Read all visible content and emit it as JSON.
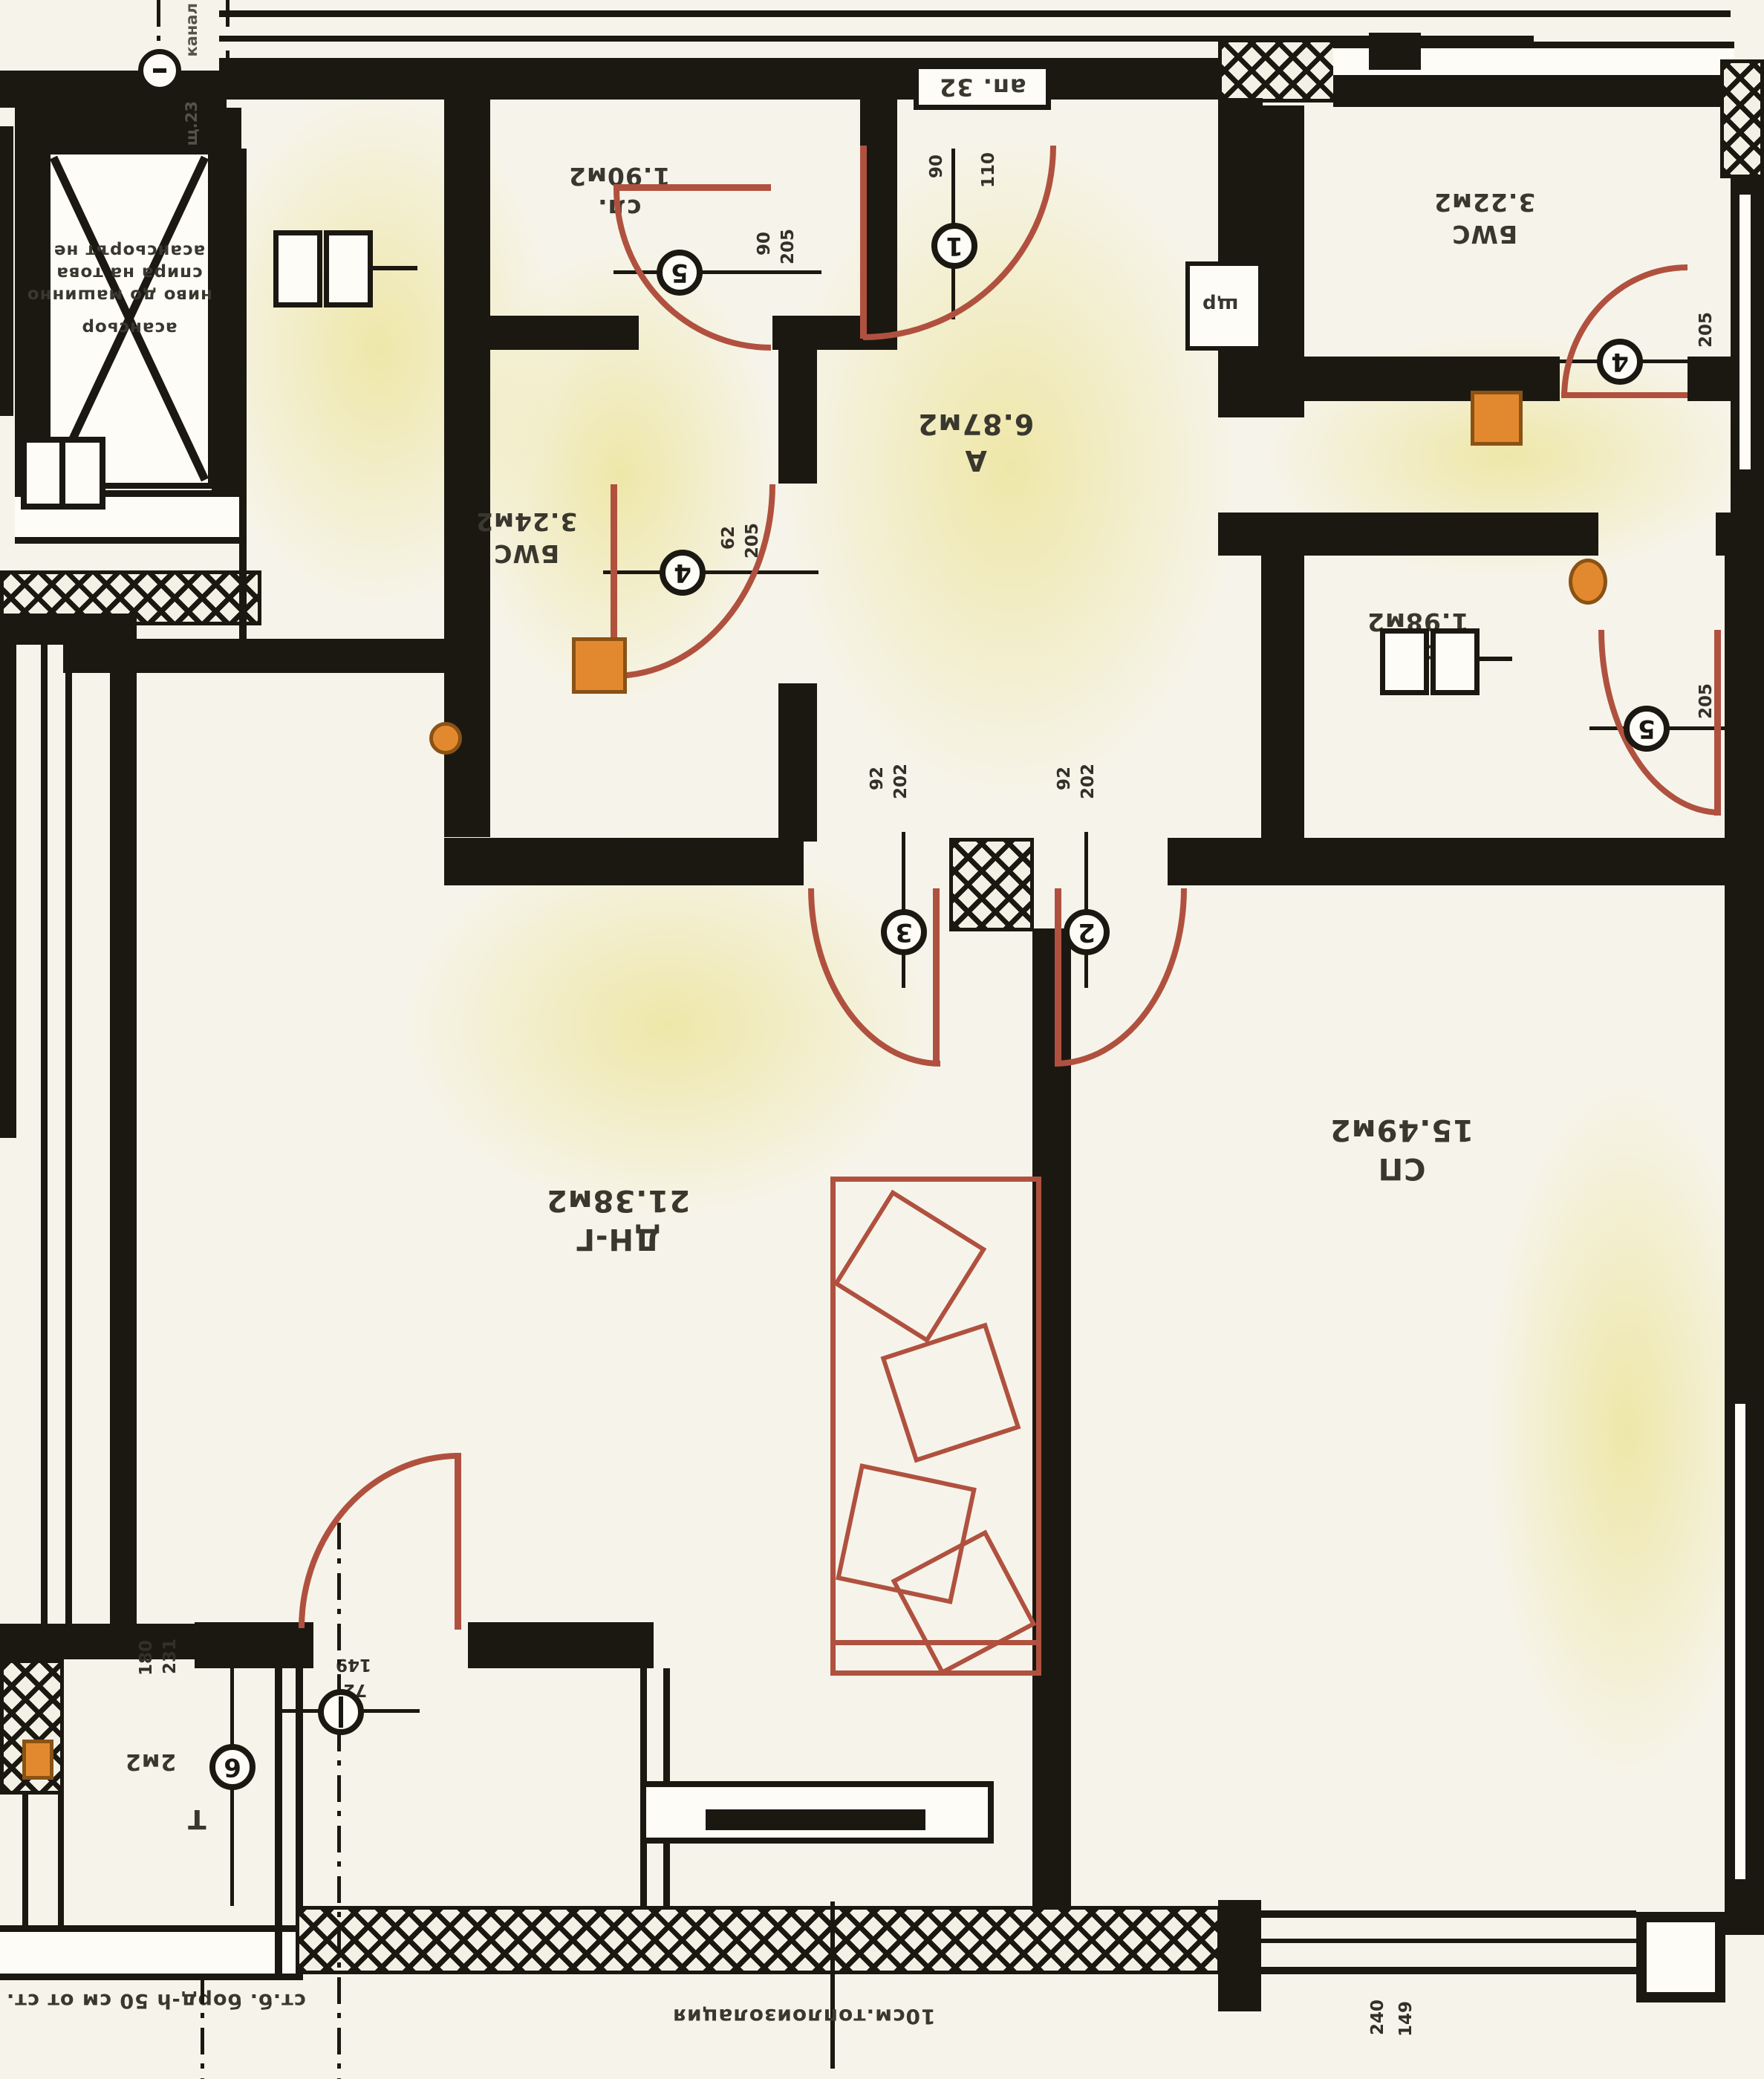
{
  "apartment": {
    "number_box": "ап. 32"
  },
  "rooms": [
    {
      "id": "hall",
      "name": "А",
      "area": "6.87м2"
    },
    {
      "id": "closet1",
      "name": "сл.",
      "area": "1.90м2"
    },
    {
      "id": "bath1",
      "name": "БWC",
      "area": "3.24м2"
    },
    {
      "id": "bath2",
      "name": "БWC",
      "area": "3.22м2"
    },
    {
      "id": "closet2",
      "name": "сл.",
      "area": "1.98м2"
    },
    {
      "id": "living",
      "name": "ДН-Г",
      "area": "21.38м2"
    },
    {
      "id": "bedroom",
      "name": "СП",
      "area": "15.49м2"
    },
    {
      "id": "terrace",
      "name": "Т",
      "area": "2м2"
    }
  ],
  "doors": [
    {
      "number": "1",
      "dims": [
        "90",
        "110"
      ]
    },
    {
      "number": "2",
      "dims": [
        "92",
        "202"
      ]
    },
    {
      "number": "3",
      "dims": [
        "92",
        "202"
      ]
    },
    {
      "number": "4",
      "dims": [
        "62",
        "205"
      ]
    },
    {
      "number": "4",
      "dims": [
        "205"
      ]
    },
    {
      "number": "5",
      "dims": [
        "90",
        "205"
      ]
    },
    {
      "number": "5",
      "dims": [
        "205"
      ]
    },
    {
      "number": "6",
      "dims": [
        "180",
        "231"
      ]
    }
  ],
  "windows": [
    {
      "id": "terrace-window",
      "dims": [
        "149",
        "72"
      ]
    },
    {
      "id": "bedroom-window",
      "dims": [
        "240",
        "149"
      ]
    }
  ],
  "annotations": {
    "insulation": "10см.топлоизолация",
    "parapet": "ст.б. борд-h 50 см от ст.",
    "elevator_label": "асансьор",
    "elevator_note_lines": [
      "асансьорът не",
      "спира на това",
      "ниво до машинно"
    ],
    "axis_text_top": "канал",
    "axis_text_bottom": "щ.23",
    "shaft_label": "щр"
  },
  "colors": {
    "wall": "#1b1812",
    "paper": "#f6f4ea",
    "door_arc": "#b0513f",
    "fixture_orange": "#e2892f",
    "tint_yellow": "#ece28a"
  }
}
